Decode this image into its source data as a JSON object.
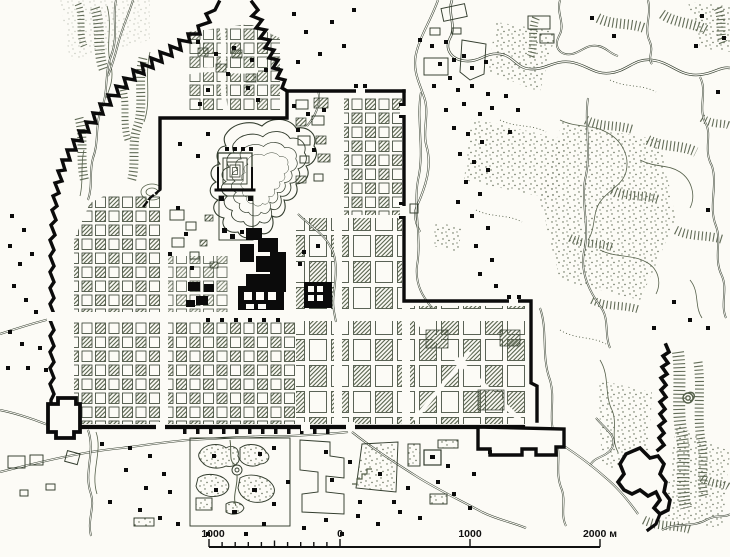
{
  "map": {
    "kind": "archaeological city plan, hand-drawn ink map",
    "scale_bar": {
      "left_label": "1000",
      "zero_label": "0",
      "right_label": "1000",
      "end_label": "2000 м",
      "unit": "м",
      "major_interval_m": 1000,
      "minor_interval_m": 100
    },
    "colors": {
      "paper": "#fcfbf6",
      "ink": "#333d2e",
      "hatch": "#55604a",
      "wall": "#0b0b0b",
      "text": "#101010"
    }
  }
}
